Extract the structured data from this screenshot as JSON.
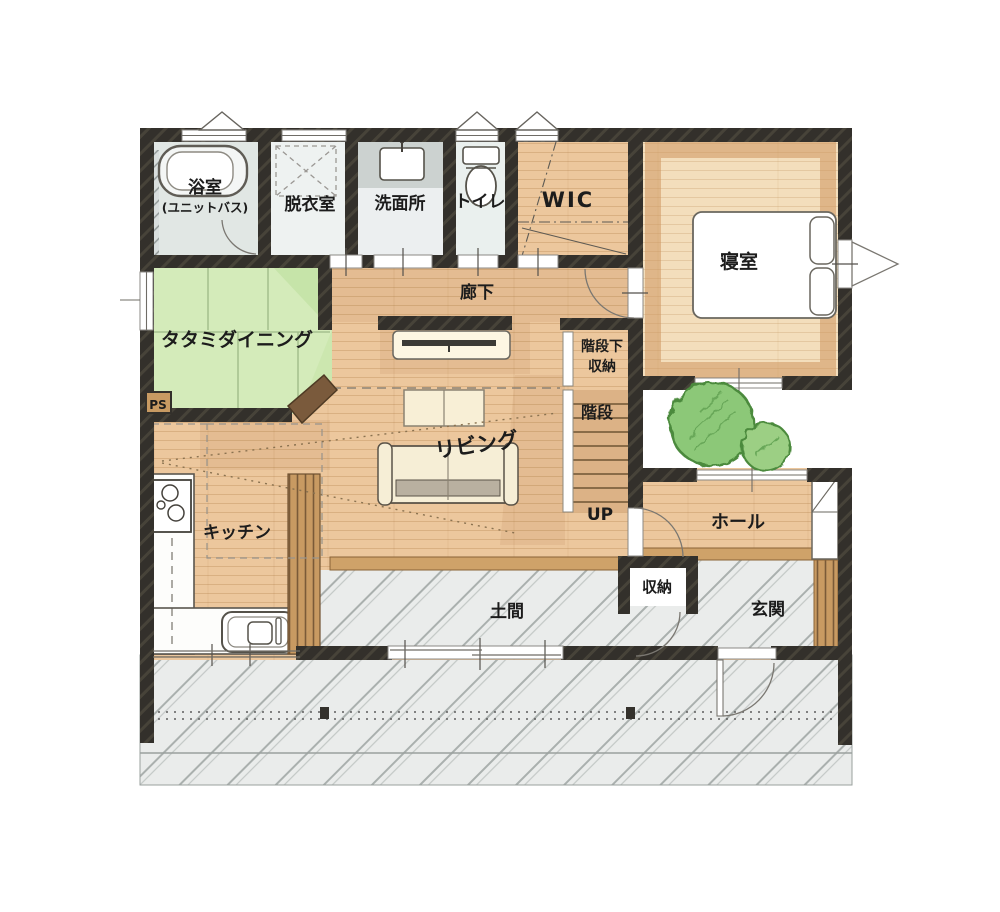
{
  "plan": {
    "rooms": {
      "bath": {
        "name": "浴室",
        "sub": "(ユニットバス)"
      },
      "dressing_room": "脱衣室",
      "washroom": "洗面所",
      "toilet": "トイレ",
      "walk_in_closet": "WIC",
      "bedroom": "寝室",
      "tatami_dining": "タタミダイニング",
      "corridor": "廊下",
      "under_stairs_storage": {
        "line1": "階段下",
        "line2": "収納"
      },
      "stairs": "階段",
      "stairs_direction": "UP",
      "living": "リビング",
      "kitchen": "キッチン",
      "hall": "ホール",
      "storage": "収納",
      "doma": "土間",
      "entrance": "玄関",
      "pipe_space": "PS"
    },
    "colors": {
      "wall": "#33302b",
      "wood_floor": "#ecc79d",
      "bedroom_floor": "#f3debc",
      "tatami": "#d4ebba",
      "wet_area_floor": "#e7ecea",
      "earthen_floor": "#eaeceb",
      "wood_accent": "#cfa269",
      "tree": "#8cc878"
    }
  }
}
